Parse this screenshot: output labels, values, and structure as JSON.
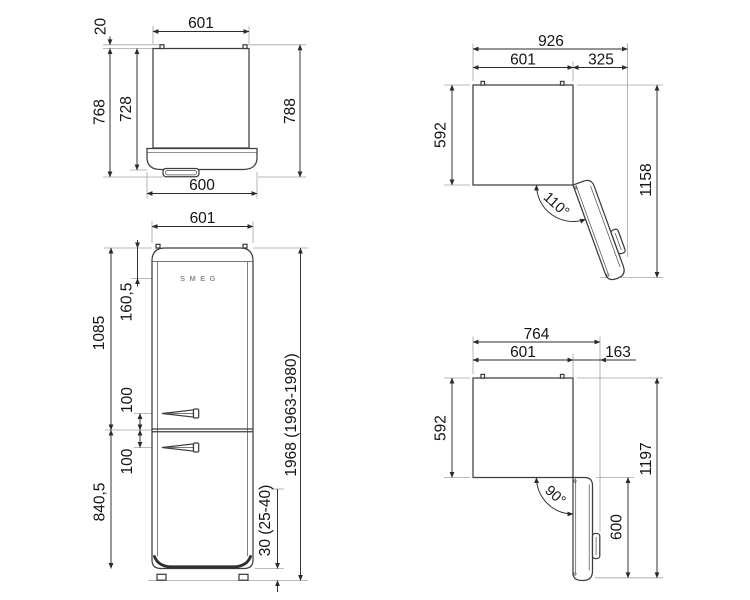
{
  "drawing": {
    "title": "refrigerator-dimension-drawing",
    "units": "mm",
    "colors": {
      "line": "#3d3d3d",
      "dimension": "#2b2b2b",
      "extension": "#a3a3a3",
      "background": "#ffffff"
    }
  },
  "views": {
    "top": {
      "label": "top-view",
      "d_width": "601",
      "d_hinge_gap": "20",
      "d_depth_with_handle": "768",
      "d_depth_body": "728",
      "d_depth_total": "788",
      "d_door_width": "600"
    },
    "front": {
      "label": "front-view",
      "logo": "SMEG",
      "d_width": "601",
      "d_logo_from_top": "160,5",
      "d_upper_section": "1085",
      "d_handle_upper": "100",
      "d_handle_lower": "100",
      "d_lower_section": "840,5",
      "d_total_height": "1968 (1963-1980)",
      "d_feet": "30 (25-40)"
    },
    "open110": {
      "label": "plan-view-door-110",
      "d_total_width": "926",
      "d_body_width": "601",
      "d_door_extra": "325",
      "d_body_depth": "592",
      "d_total_depth": "1158",
      "angle": "110°"
    },
    "open90": {
      "label": "plan-view-door-90",
      "d_total_width": "764",
      "d_body_width": "601",
      "d_door_extra": "163",
      "d_body_depth": "592",
      "d_total_depth": "1197",
      "d_door_length": "600",
      "angle": "90°"
    }
  }
}
